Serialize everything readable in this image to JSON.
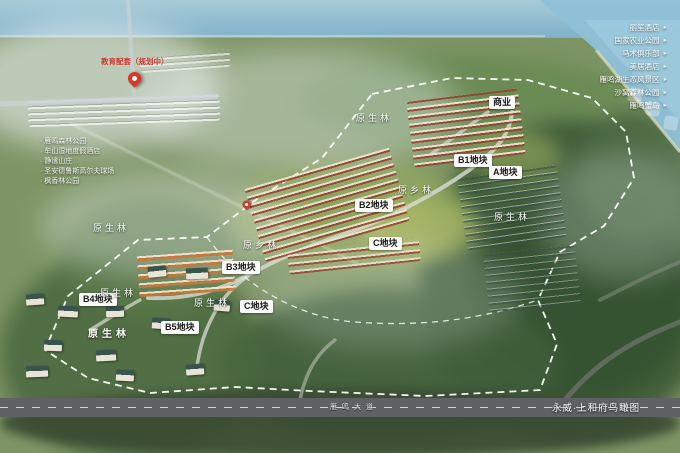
{
  "caption": "永威·上和府鸟瞰图",
  "road_label": "雁鸣大道",
  "education": {
    "label": "教育配套（规划中）"
  },
  "business": {
    "label": "商业"
  },
  "plots": [
    {
      "id": "B1",
      "label": "B1地块"
    },
    {
      "id": "A",
      "label": "A地块"
    },
    {
      "id": "B2",
      "label": "B2地块"
    },
    {
      "id": "C-upper",
      "label": "C地块"
    },
    {
      "id": "B3",
      "label": "B3地块"
    },
    {
      "id": "C-lower",
      "label": "C地块"
    },
    {
      "id": "B4",
      "label": "B4地块"
    },
    {
      "id": "B5",
      "label": "B5地块"
    }
  ],
  "forest_labels": [
    {
      "text": "原生林"
    },
    {
      "text": "原乡林"
    },
    {
      "text": "原生林"
    },
    {
      "text": "原生林"
    },
    {
      "text": "原乡林"
    },
    {
      "text": "原生林"
    },
    {
      "text": "原生林"
    },
    {
      "text": "原生林"
    }
  ],
  "amenities_left": [
    {
      "label": "雁鸣森林公园"
    },
    {
      "label": "牟山湿地度假酒店"
    },
    {
      "label": "静谧山庄"
    },
    {
      "label": "圣安德鲁斯高尔夫球场"
    },
    {
      "label": "枫香林公园"
    }
  ],
  "amenities_right": [
    {
      "label": "丽笙酒店"
    },
    {
      "label": "国家农业公园"
    },
    {
      "label": "马术俱乐部"
    },
    {
      "label": "美居酒店"
    },
    {
      "label": "雁鸣湖生态风景区"
    },
    {
      "label": "沙窝森林公园"
    },
    {
      "label": "雁鸣蟹岛"
    }
  ],
  "icons": {
    "arrow": "►"
  },
  "colors": {
    "pin_red": "#d8372c",
    "boundary_white": "#ffffff",
    "water_blue": "#8fc0d8",
    "label_bg": "#ffffff",
    "forest_dark": "#3c5a36"
  }
}
